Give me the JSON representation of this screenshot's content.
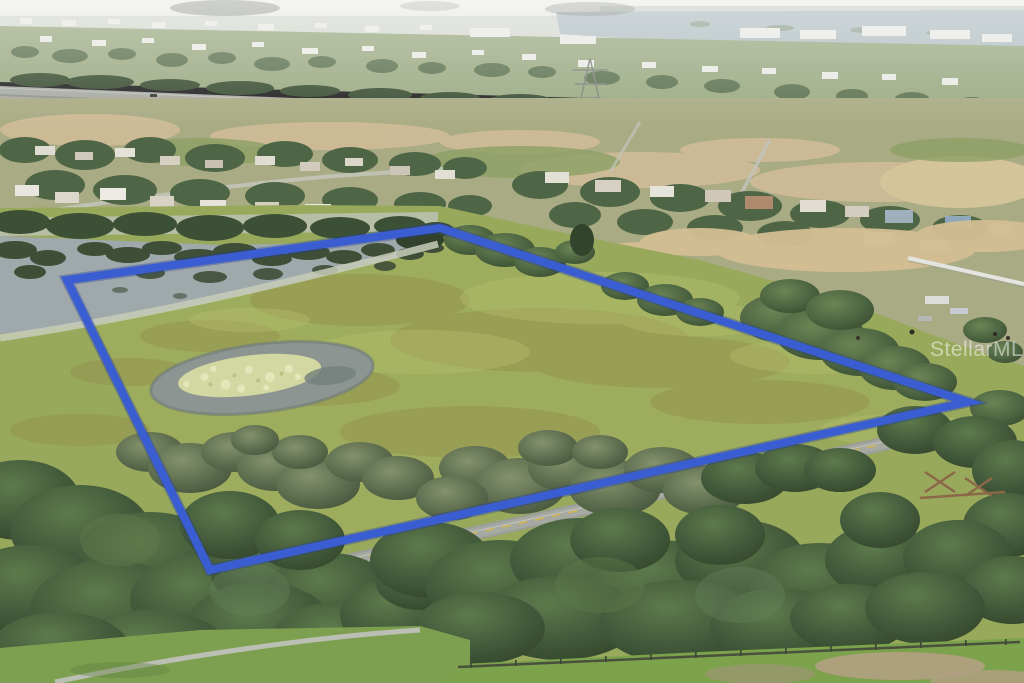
{
  "image": {
    "type": "aerial-drone-photograph",
    "description": "Aerial view of a vacant land parcel outlined with a blue boundary line; lake with lily pads at top-left of parcel, small sand-bottom pond mid-left, green pasture, tree rows along a two-lane road at the bottom edge, suburban neighborhoods and a highway in the distance",
    "width": 1024,
    "height": 683
  },
  "watermark": {
    "text": "StellarMLS",
    "color": "#ffffff",
    "opacity": "0.5"
  },
  "boundary": {
    "points": "67,280 440,228 968,402 210,570",
    "color": "#3a5ed2",
    "underlay_color": "#243c94",
    "width": "8"
  },
  "colors": {
    "sky": "#e9ebe5",
    "far_water": "#b4c0c4",
    "distant_land": "#9cab84",
    "midland": "#a9ab84",
    "highway": "#a8aaa4",
    "field": "#99a95c",
    "lake_water": "#9fa8ab",
    "lake_vegetation": "#3e4e37",
    "pond_water": "#8d9593",
    "pond_sandbar": "#d3d7a1",
    "road": "#9b9d97",
    "road_centerline": "#d2b94b",
    "path": "#bcbfb4",
    "fence": "#49513e",
    "grass_bottom": "#7ca24c",
    "sand": "#d4be93",
    "house_white": "#e8e6de"
  }
}
